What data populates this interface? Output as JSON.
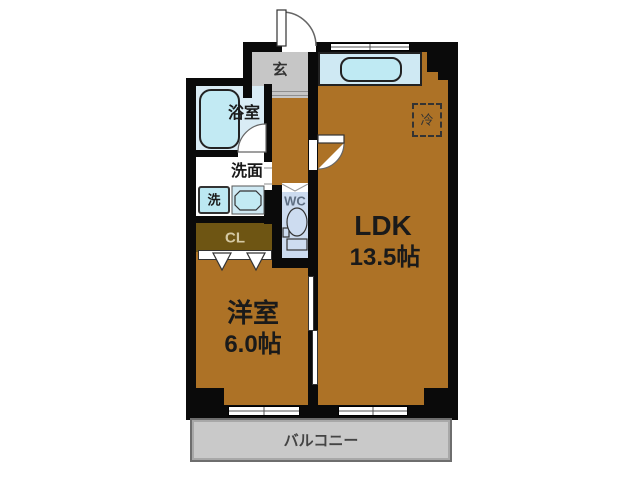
{
  "title": "apartment-floor-plan",
  "colors": {
    "wall": "#0a0a0a",
    "wood_floor": "#ad7226",
    "closet_floor": "#6e5513",
    "entry_gray": "#c6c6c6",
    "balcony_gray": "#c9c9c9",
    "bath_floor": "#d9ecf5",
    "wc_floor": "#ccdbef",
    "fixture_blue": "#c2eaf3"
  },
  "rooms": {
    "entrance": {
      "label": "玄"
    },
    "bathroom": {
      "label": "浴室"
    },
    "washroom": {
      "label": "洗面"
    },
    "washer": {
      "label": "洗"
    },
    "toilet": {
      "label": "WC"
    },
    "closet": {
      "label": "CL"
    },
    "refrigerator": {
      "label": "冷"
    },
    "ldk": {
      "label": "LDK",
      "size": "13.5帖"
    },
    "western_room": {
      "label": "洋室",
      "size": "6.0帖"
    },
    "balcony": {
      "label": "バルコニー"
    }
  }
}
